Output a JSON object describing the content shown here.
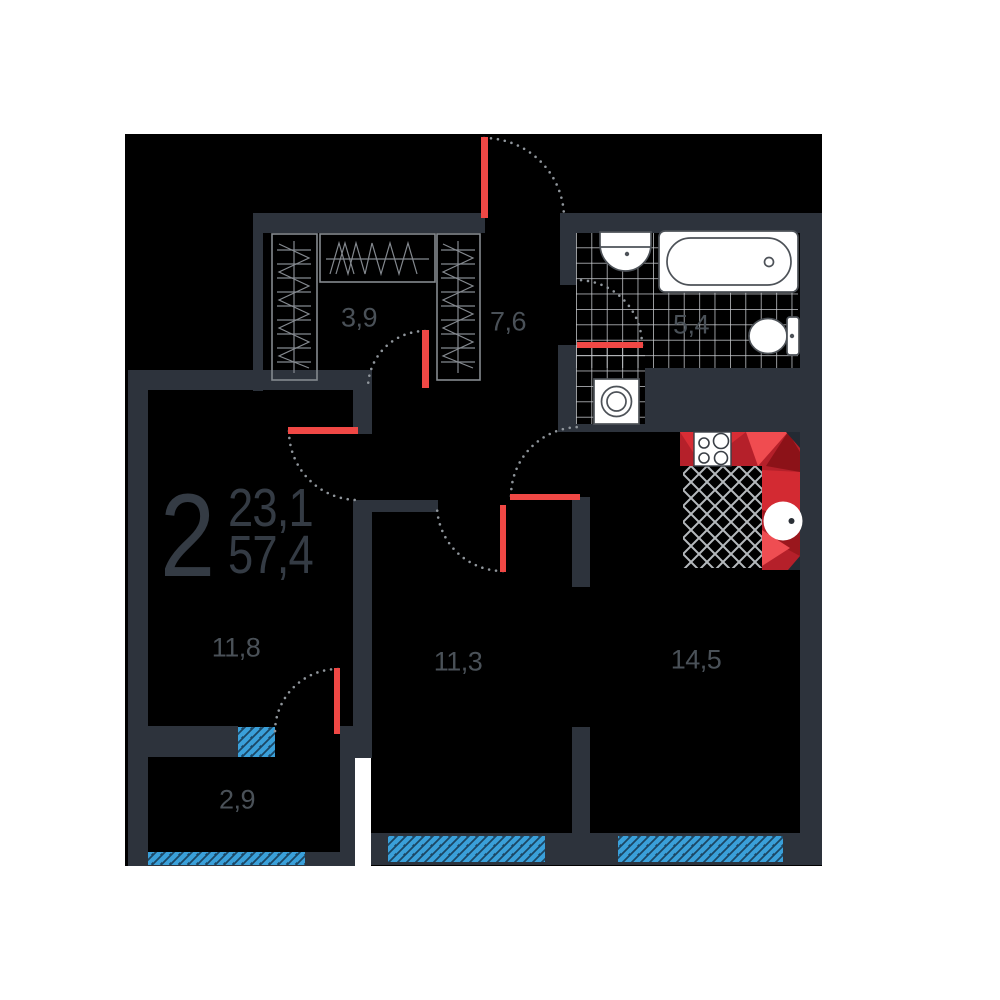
{
  "plan": {
    "apartment": {
      "rooms_count": "2",
      "living_area": "23,1",
      "total_area": "57,4"
    },
    "rooms": [
      {
        "id": "wardrobe",
        "area": "3,9"
      },
      {
        "id": "hallway",
        "area": "7,6"
      },
      {
        "id": "bathroom",
        "area": "5,4"
      },
      {
        "id": "bedroom",
        "area": "11,8"
      },
      {
        "id": "room-second",
        "area": "11,3"
      },
      {
        "id": "kitchen-living",
        "area": "14,5"
      },
      {
        "id": "balcony",
        "area": "2,9"
      }
    ],
    "fixtures": [
      "bathtub",
      "wash-basin",
      "toilet",
      "washing-machine",
      "stove",
      "kitchen-sink",
      "wardrobe-rails"
    ],
    "colors": {
      "background": "#ffffff",
      "floor": "#000000",
      "wall": "#2d333c",
      "door": "#f04845",
      "window": "#3aa0da",
      "kitchen_counter": "#b5202a",
      "tile_line": "#c9ccd0",
      "label": "#4a5158"
    }
  }
}
